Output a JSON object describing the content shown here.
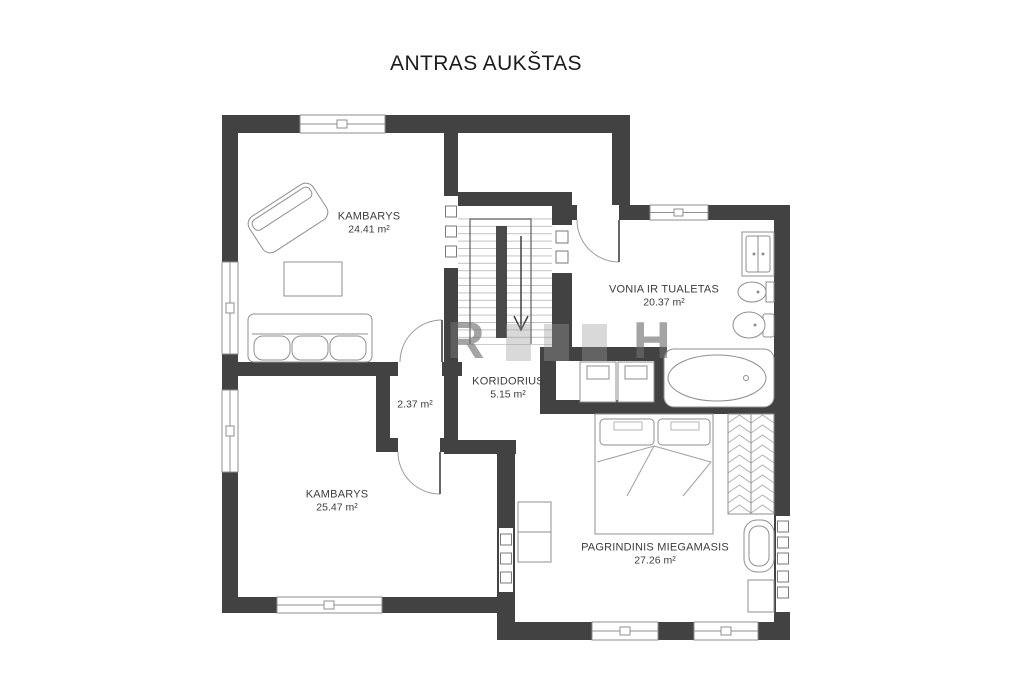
{
  "title": "ANTRAS AUKŠTAS",
  "floor_plan": {
    "rooms": [
      {
        "name": "KAMBARYS",
        "area": "24.41 m²"
      },
      {
        "name": "VONIA IR TUALETAS",
        "area": "20.37 m²"
      },
      {
        "name": "KORIDORIUS",
        "area": "5.15 m²"
      },
      {
        "name": "",
        "area": "2.37 m²"
      },
      {
        "name": "KAMBARYS",
        "area": "25.47 m²"
      },
      {
        "name": "PAGRINDINIS MIEGAMASIS",
        "area": "27.26 m²"
      }
    ],
    "stairs": {
      "direction_arrow": "down"
    },
    "watermark_letters": [
      "R",
      "H"
    ],
    "colors": {
      "wall": "#424242",
      "furniture_outline": "#8f8f8f",
      "label_text": "#3c3c3c",
      "background": "#ffffff"
    }
  }
}
